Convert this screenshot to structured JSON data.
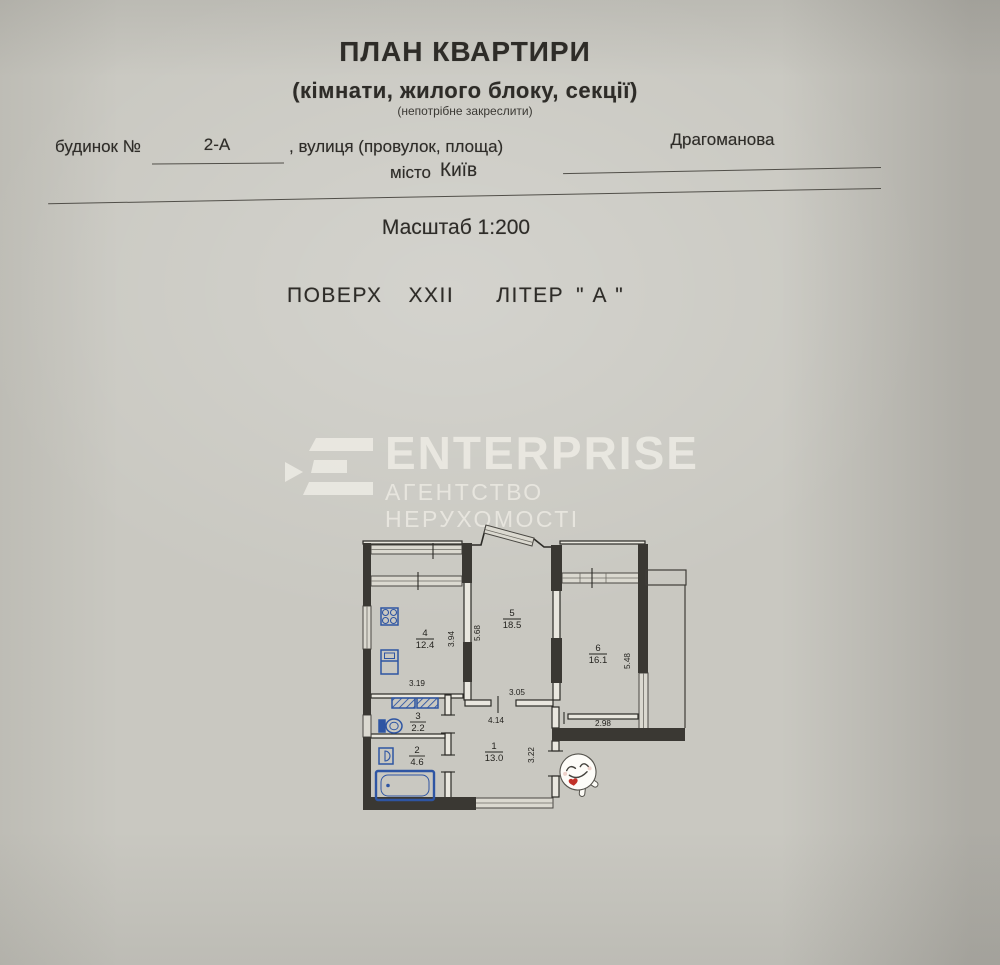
{
  "document": {
    "title": "ПЛАН КВАРТИРИ",
    "subtitle": "(кімнати, жилого блоку, секції)",
    "note": "(непотрібне закреслити)",
    "building_label": "будинок №",
    "building_number": "2-А",
    "street_label": ", вулиця (провулок, площа)",
    "street_value": "Драгоманова",
    "city_label": "місто",
    "city_value": "Київ",
    "scale_text": "Масштаб 1:200",
    "floor_label": "ПОВЕРХ",
    "floor_value": "XXII",
    "letter_label": "ЛІТЕР",
    "letter_value": "\" А \""
  },
  "watermark": {
    "name": "ENTERPRISE",
    "tagline": "АГЕНТСТВО НЕРУХОМОСТІ",
    "logo_icon": "enterprise-chevron-e-logo"
  },
  "floor_plan": {
    "rooms": [
      {
        "number": "1",
        "area": "13.0"
      },
      {
        "number": "2",
        "area": "4.6"
      },
      {
        "number": "3",
        "area": "2.2"
      },
      {
        "number": "4",
        "area": "12.4"
      },
      {
        "number": "5",
        "area": "18.5"
      },
      {
        "number": "6",
        "area": "16.1"
      }
    ],
    "dimensions": [
      "3.94",
      "5.68",
      "3.19",
      "3.05",
      "4.14",
      "3.22",
      "2.98",
      "5.48"
    ],
    "fixtures": [
      "stove-icon",
      "kitchen-sink-icon",
      "washing-machine-icon",
      "toilet-icon",
      "washbasin-icon",
      "bathtub-icon"
    ],
    "sticker": "smiley-face-sticker"
  },
  "colors": {
    "paper": "#c9c8c1",
    "ink": "#2e2c28",
    "wall_dark": "#3a3833",
    "fixture_blue": "#2e55a3",
    "watermark_white": "#eceae3",
    "sticker_heart": "#c23128"
  }
}
